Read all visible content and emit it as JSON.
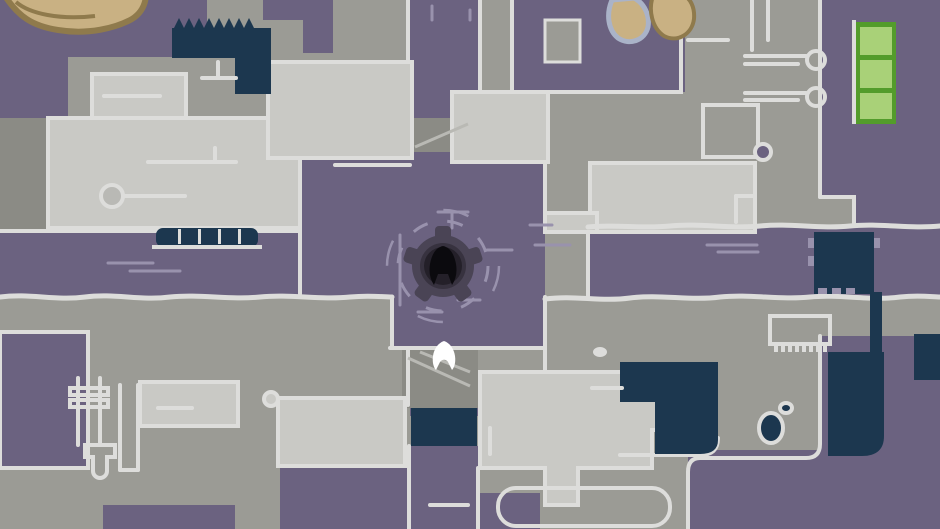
{
  "meta": {
    "view": "game-map-screen",
    "description": "Top-down dungeon map: purple floor corridors in a cross layout, light-gray rooms with white outlines, dark navy pits and pools, a central gear-shaped objective marker containing a dark ghost glyph, and a white ghost player character standing below it"
  },
  "theme": {
    "purple": "#6b6280",
    "purpleLight": "#9992ad",
    "gray": "#9b9b95",
    "grayDark": "#8b8b85",
    "light": "#c9c9c5",
    "outline": "#dddddb",
    "navy": "#1c374f",
    "tan": "#c9b183",
    "tanDark": "#8f7a4c",
    "tanBlue": "#aab3c8",
    "green": "#a9d178",
    "greenDark": "#539c2b",
    "gearBody": "#4a4455",
    "gearRing": "#37323f",
    "gearInner": "#242029",
    "glyph": "#0b0a0e",
    "white": "#ffffff"
  },
  "entities": {
    "player": {
      "name": "player-ghost",
      "aria": "White ghost player character",
      "color": "#ffffff",
      "x": 444,
      "y": 357
    },
    "objective": {
      "name": "gear-objective-marker",
      "aria": "Dark gear marker with ghost glyph resembling letter A",
      "glyph_look": "A",
      "x": 443,
      "y": 266
    },
    "crates": {
      "name": "green-crates",
      "aria": "Stack of three green crates",
      "count": 3
    },
    "mineral_deposits": {
      "count": 3,
      "color": "#c9b183"
    },
    "pools": {
      "count": 6,
      "color": "#1c374f"
    }
  }
}
